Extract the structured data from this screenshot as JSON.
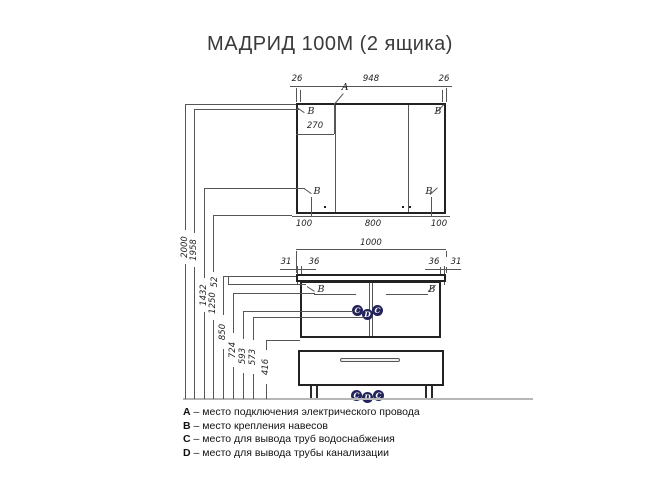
{
  "title": "МАДРИД 100М (2 ящика)",
  "colors": {
    "line": "#565656",
    "outline": "#222222",
    "floor": "#b6b6b6",
    "marker_fill": "#23235c",
    "marker_text": "#ffffff"
  },
  "mirror": {
    "dim_top": [
      "26",
      "948",
      "26"
    ],
    "dim_bottom": [
      "100",
      "800",
      "100"
    ],
    "dim_inner": "270",
    "label_a": "A",
    "label_b": "B"
  },
  "vanity": {
    "dim_width": "1000",
    "dim_left": [
      "31",
      "36"
    ],
    "dim_right": [
      "36",
      "31"
    ],
    "dim_gap": "52",
    "label_b": "B"
  },
  "heights": [
    "2000",
    "1958",
    "1432",
    "1250",
    "850",
    "724",
    "593",
    "573",
    "416"
  ],
  "plumbing": {
    "markers": [
      "C",
      "D",
      "C"
    ]
  },
  "legend": [
    {
      "key": "A",
      "text": "– место подключения электрического провода"
    },
    {
      "key": "B",
      "text": "– место крепления навесов"
    },
    {
      "key": "C",
      "text": "– место для вывода труб водоснабжения"
    },
    {
      "key": "D",
      "text": "– место для вывода трубы канализации"
    }
  ]
}
